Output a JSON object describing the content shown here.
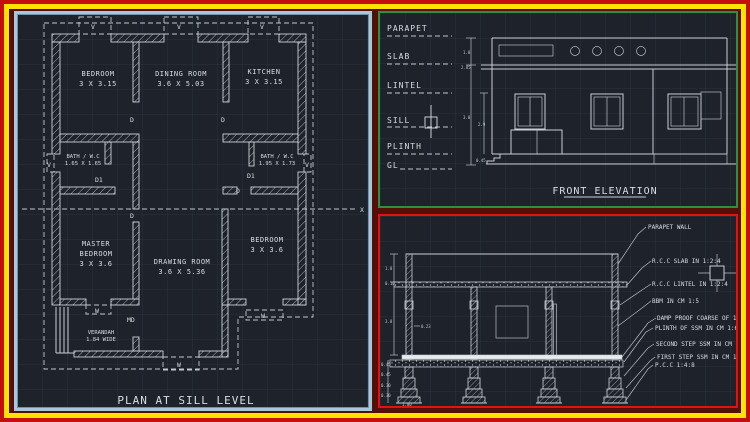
{
  "frame": {
    "outer_border_color": "#c40f0f",
    "inner_border_color": "#ffe204",
    "plan_border_color": "#a9c7da",
    "elev_border_color": "#2f8f3e",
    "sect_border_color": "#e01212",
    "canvas_color": "#1d222b"
  },
  "plan": {
    "title": "PLAN AT SILL LEVEL",
    "markers": {
      "door": "D",
      "door_small": "D1",
      "main_door": "MD",
      "window": "W",
      "ventilator": "V",
      "axis": "X"
    },
    "rooms": [
      {
        "line1": "BEDROOM",
        "line2": "3 X 3.15"
      },
      {
        "line1": "DINING ROOM",
        "line2": "3.6 X 5.03"
      },
      {
        "line1": "KITCHEN",
        "line2": "3 X 3.15"
      },
      {
        "line1": "BATH / W.C",
        "line2": "1.65 X 1.65"
      },
      {
        "line1": "BATH / W.C",
        "line2": "1.95 X 1.73"
      },
      {
        "line1": "MASTER",
        "line2": "BEDROOM",
        "line3": "3 X 3.6"
      },
      {
        "line1": "DRAWING ROOM",
        "line2": "3.6 X 5.36"
      },
      {
        "line1": "BEDROOM",
        "line2": "3 X 3.6"
      },
      {
        "line1": "VERANDAH",
        "line2": "1.84 WIDE"
      }
    ]
  },
  "elevation": {
    "title": "FRONT ELEVATION",
    "levels": [
      "PARAPET",
      "SLAB",
      "LINTEL",
      "SILL",
      "PLINTH",
      "GL"
    ],
    "dims": {
      "parapet": "1.8",
      "slab": "2.85",
      "floor": "3.8",
      "window": "2.9",
      "plinth": "0.45"
    }
  },
  "section": {
    "callouts": [
      "PARAPET WALL",
      "R.C.C SLAB IN 1:2:4",
      "R.C.C LINTEL IN 1:2:4",
      "BBM IN CM 1:5",
      "DAMP PROOF COARSE OF 1:4:8",
      "PLINTH OF SSM IN CM 1:6",
      "SECOND STEP SSM IN CM 1:6",
      "FIRST STEP SSM IN CM 1:6",
      "P.C.C 1:4:8"
    ],
    "dims": {
      "parapet": "1.8",
      "slab": "0.10",
      "wall_height": "3.8",
      "wall_thk": "0.23",
      "plinth": "0.45",
      "step1": "0.45",
      "step2": "0.30",
      "step3": "0.30",
      "base_width": "1.00"
    }
  }
}
